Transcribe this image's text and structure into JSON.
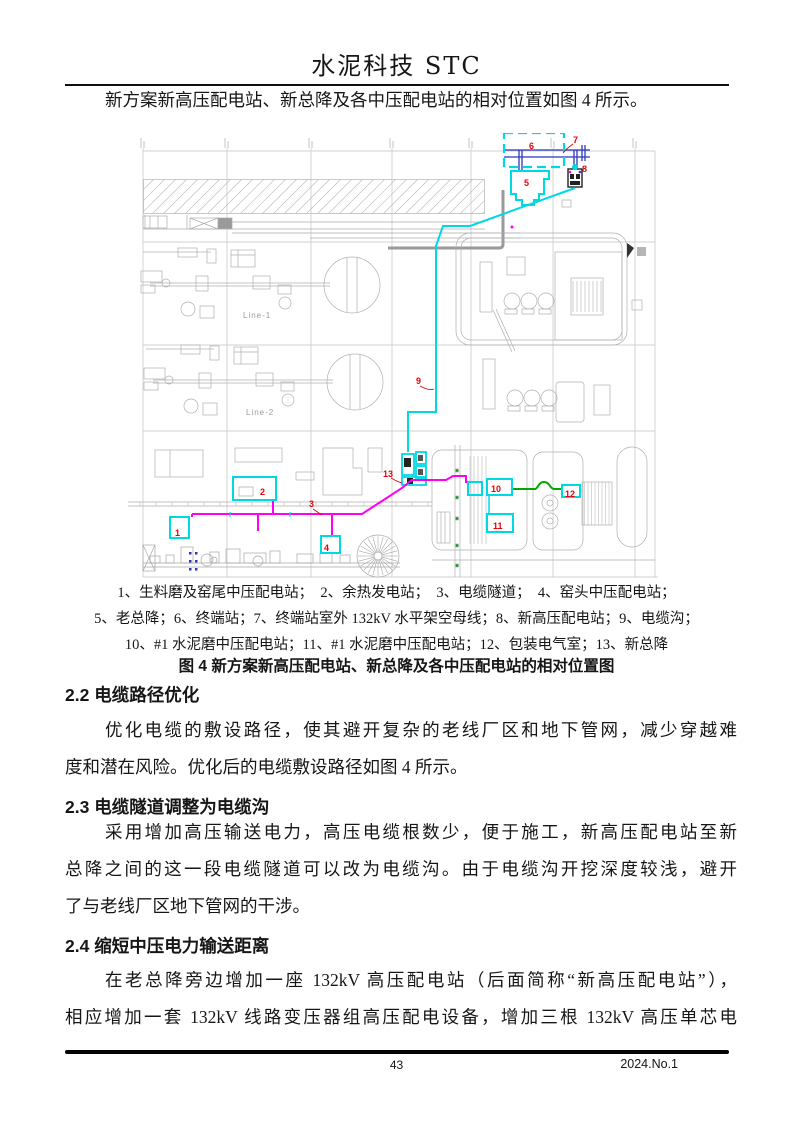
{
  "header": {
    "journal_title": "水泥科技 STC"
  },
  "intro_paragraph": "新方案新高压配电站、新总降及各中压配电站的相对位置如图 4 所示。",
  "figure": {
    "legend_lines": [
      "1、生料磨及窑尾中压配电站；　2、余热发电站；　3、电缆隧道；　4、窑头中压配电站；",
      "5、老总降；6、终端站；7、终端站室外 132kV 水平架空母线；8、新高压配电站；9、电缆沟；",
      "10、#1 水泥磨中压配电站；11、#1 水泥磨中压配电站；12、包装电气室；13、新总降"
    ],
    "caption": "图 4 新方案新高压配电站、新总降及各中压配电站的相对位置图",
    "line1_label": "Line-1",
    "line2_label": "Line-2",
    "markers": [
      {
        "n": "1",
        "x": 175,
        "y": 536
      },
      {
        "n": "2",
        "x": 260,
        "y": 495
      },
      {
        "n": "3",
        "x": 309,
        "y": 507
      },
      {
        "n": "4",
        "x": 324,
        "y": 551
      },
      {
        "n": "5",
        "x": 524,
        "y": 186
      },
      {
        "n": "6",
        "x": 529,
        "y": 149
      },
      {
        "n": "7",
        "x": 573,
        "y": 143
      },
      {
        "n": "8",
        "x": 582,
        "y": 172
      },
      {
        "n": "9",
        "x": 416,
        "y": 384
      },
      {
        "n": "10",
        "x": 491,
        "y": 492
      },
      {
        "n": "11",
        "x": 493,
        "y": 529
      },
      {
        "n": "12",
        "x": 565,
        "y": 497
      },
      {
        "n": "13",
        "x": 383,
        "y": 477
      }
    ]
  },
  "sections": [
    {
      "heading": "2.2 电缆路径优化",
      "lines": [
        {
          "t": "优化电缆的敷设路径，使其避开复杂的老线厂区和地下管网，减少穿越难",
          "indent": true,
          "just": true
        },
        {
          "t": "度和潜在风险。优化后的电缆敷设路径如图 4 所示。"
        }
      ]
    },
    {
      "heading": "2.3 电缆隧道调整为电缆沟",
      "lines": [
        {
          "t": "采用增加高压输送电力，高压电缆根数少，便于施工，新高压配电站至新",
          "indent": true,
          "just": true
        },
        {
          "t": "总降之间的这一段电缆隧道可以改为电缆沟。由于电缆沟开挖深度较浅，避开",
          "just": true
        },
        {
          "t": "了与老线厂区地下管网的干涉。"
        }
      ]
    },
    {
      "heading": "2.4 缩短中压电力输送距离",
      "lines": [
        {
          "t": "在老总降旁边增加一座 132kV 高压配电站（后面简称“新高压配电站”），",
          "indent": true,
          "just": true
        },
        {
          "t": "相应增加一套 132kV 线路变压器组高压配电设备，增加三根 132kV 高压单芯电",
          "just": true
        }
      ]
    }
  ],
  "footer": {
    "page_number": "43",
    "issue": "2024.No.1"
  },
  "colors": {
    "cyan": "#00d8e4",
    "magenta": "#ff00f0",
    "green": "#00a800",
    "red": "#e8000c",
    "blue": "#2b35c0",
    "grid_grey": "#b0b0b0"
  }
}
